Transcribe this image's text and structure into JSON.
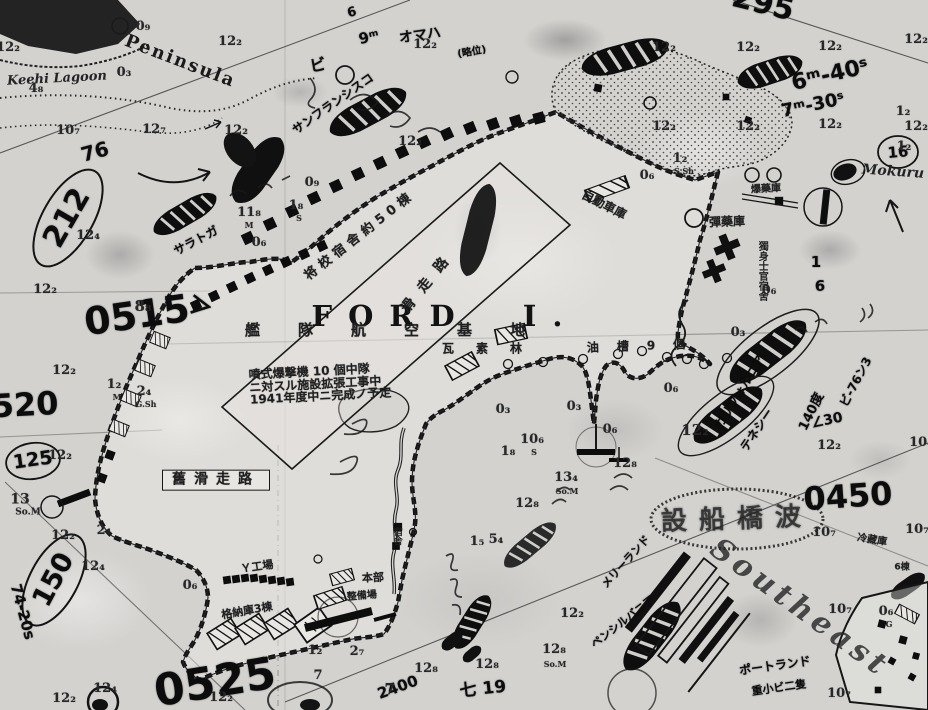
{
  "meta": {
    "chart_subject": "FORD  I."
  },
  "labels": [
    {
      "n": "island-name",
      "t": "FORD  I.",
      "x": 445,
      "y": 316,
      "fs": 29,
      "ls": 16,
      "cls": "print-big"
    },
    {
      "n": "place-name-keehi-lagoon",
      "t": "Keehi Lagoon",
      "x": 57,
      "y": 79,
      "fs": 13,
      "rot": -3,
      "cls": "italic"
    },
    {
      "n": "place-name-peninsula",
      "t": "Peninsula",
      "x": 180,
      "y": 62,
      "fs": 18,
      "rot": 21,
      "ls": 2,
      "cls": "print-serif"
    },
    {
      "n": "place-name-mokuru",
      "t": "Mokuru",
      "x": 893,
      "y": 172,
      "fs": 14,
      "rot": 4,
      "cls": "italic"
    },
    {
      "n": "place-name-southeast",
      "t": "Southeast",
      "x": 800,
      "y": 608,
      "fs": 30,
      "rot": 36,
      "ls": 5,
      "cls": "italic faint"
    },
    {
      "n": "handwritten-time-0515",
      "t": "0515",
      "x": 137,
      "y": 316,
      "fs": 38,
      "rot": -8,
      "cls": "hand"
    },
    {
      "n": "handwritten-number-212",
      "t": "212",
      "x": 67,
      "y": 218,
      "fs": 30,
      "rot": -60,
      "cls": "hand"
    },
    {
      "n": "handwritten-number-76",
      "t": "76",
      "x": 95,
      "y": 152,
      "fs": 20,
      "rot": -15,
      "cls": "hand"
    },
    {
      "n": "handwritten-time-0520",
      "t": "0520",
      "x": 14,
      "y": 406,
      "fs": 32,
      "rot": -3,
      "cls": "hand"
    },
    {
      "n": "handwritten-number-125",
      "t": "125",
      "x": 33,
      "y": 461,
      "fs": 19,
      "rot": -8,
      "cls": "hand"
    },
    {
      "n": "handwritten-number-150",
      "t": "150",
      "x": 54,
      "y": 580,
      "fs": 27,
      "rot": -62,
      "cls": "hand"
    },
    {
      "n": "handwritten-note-74-20s",
      "t": "74-20s",
      "x": 22,
      "y": 612,
      "fs": 15,
      "rot": 75,
      "cls": "hand"
    },
    {
      "n": "handwritten-time-0525",
      "t": "0525",
      "x": 215,
      "y": 683,
      "fs": 44,
      "rot": -9,
      "cls": "hand"
    },
    {
      "n": "handwritten-time-0450",
      "t": "0450",
      "x": 848,
      "y": 497,
      "fs": 32,
      "rot": -4,
      "cls": "hand"
    },
    {
      "n": "handwritten-number-295",
      "t": "295",
      "x": 763,
      "y": 4,
      "fs": 30,
      "rot": 14,
      "cls": "hand"
    },
    {
      "n": "handwritten-time-6m40s",
      "t": "6ᵐ-40ˢ",
      "x": 830,
      "y": 75,
      "fs": 22,
      "rot": -13,
      "cls": "hand"
    },
    {
      "n": "handwritten-time-7m30s",
      "t": "7ᵐ-30ˢ",
      "x": 813,
      "y": 106,
      "fs": 18,
      "rot": -12,
      "cls": "hand"
    },
    {
      "n": "handwritten-note-140deg",
      "t": "140度",
      "x": 812,
      "y": 412,
      "fs": 13,
      "rot": -64,
      "cls": "hand"
    },
    {
      "n": "handwritten-note-bi76",
      "t": "ビ-76ン3",
      "x": 856,
      "y": 382,
      "fs": 12,
      "rot": -62,
      "cls": "hand"
    },
    {
      "n": "handwritten-note-30",
      "t": "∠30",
      "x": 827,
      "y": 421,
      "fs": 14,
      "rot": -12,
      "cls": "hand"
    },
    {
      "n": "handwritten-number-16",
      "t": "16",
      "x": 898,
      "y": 153,
      "fs": 15,
      "rot": -5,
      "cls": "hand"
    },
    {
      "n": "handwritten-number-1",
      "t": "1",
      "x": 816,
      "y": 263,
      "fs": 15,
      "cls": "hand"
    },
    {
      "n": "handwritten-number-6",
      "t": "6",
      "x": 820,
      "y": 287,
      "fs": 15,
      "cls": "hand"
    },
    {
      "n": "handwritten-note-hi19",
      "t": "七 19",
      "x": 483,
      "y": 690,
      "fs": 17,
      "rot": -6,
      "cls": "hand"
    },
    {
      "n": "handwritten-number-2400",
      "t": "2400",
      "x": 398,
      "y": 688,
      "fs": 15,
      "rot": -20,
      "cls": "hand"
    },
    {
      "n": "handwritten-ship-omaha",
      "t": "オマハ",
      "x": 420,
      "y": 36,
      "fs": 14,
      "rot": -8,
      "cls": "hand"
    },
    {
      "n": "handwritten-time-9m",
      "t": "9ᵐ",
      "x": 369,
      "y": 38,
      "fs": 15,
      "rot": -12,
      "cls": "hand"
    },
    {
      "n": "handwritten-number-6b",
      "t": "6",
      "x": 352,
      "y": 13,
      "fs": 13,
      "rot": -15,
      "cls": "hand"
    },
    {
      "n": "handwritten-note-bi",
      "t": "ビ",
      "x": 318,
      "y": 66,
      "fs": 16,
      "rot": -10,
      "cls": "hand"
    },
    {
      "n": "handwritten-note-ryakui",
      "t": "(略位)",
      "x": 472,
      "y": 53,
      "fs": 10,
      "rot": -10,
      "cls": "hand"
    },
    {
      "n": "handwritten-ship-san-francisco",
      "t": "サンフランシスコ",
      "x": 333,
      "y": 104,
      "fs": 12,
      "rot": -35,
      "cls": "hand"
    },
    {
      "n": "handwritten-ship-saratoga",
      "t": "サラトガ",
      "x": 196,
      "y": 241,
      "fs": 12,
      "rot": -28,
      "cls": "hand"
    },
    {
      "n": "handwritten-ship-california",
      "t": "カリフォルニア",
      "x": 740,
      "y": 392,
      "fs": 12,
      "rot": -58,
      "cls": "hand"
    },
    {
      "n": "handwritten-ship-tennessee",
      "t": "テネシー",
      "x": 757,
      "y": 430,
      "fs": 12,
      "rot": -56,
      "cls": "hand"
    },
    {
      "n": "handwritten-ship-maryland",
      "t": "メリーランド",
      "x": 626,
      "y": 562,
      "fs": 11,
      "rot": -48,
      "cls": "hand"
    },
    {
      "n": "handwritten-ship-pennsylvania",
      "t": "ペンシルバニア",
      "x": 623,
      "y": 622,
      "fs": 11,
      "rot": -38,
      "cls": "hand"
    },
    {
      "n": "handwritten-ship-portland",
      "t": "ポートランド",
      "x": 775,
      "y": 666,
      "fs": 12,
      "rot": -8,
      "cls": "hand"
    },
    {
      "n": "handwritten-note-ships",
      "t": "重小ビ二隻",
      "x": 779,
      "y": 688,
      "fs": 11,
      "rot": -8,
      "cls": "hand"
    },
    {
      "n": "handwritten-arrow-mark",
      "t": "＞",
      "x": 201,
      "y": 307,
      "fs": 24,
      "rot": 10,
      "cls": "hand"
    },
    {
      "n": "jp-label-auto-garage",
      "t": "自動車庫",
      "x": 604,
      "y": 205,
      "fs": 12,
      "rot": 27,
      "cls": "jp"
    },
    {
      "n": "jp-label-bomb-magazine",
      "t": "爆藥庫",
      "x": 766,
      "y": 190,
      "fs": 10,
      "rot": -3,
      "cls": "jp"
    },
    {
      "n": "jp-label-ammo-depot",
      "t": "彈藥庫",
      "x": 727,
      "y": 222,
      "fs": 12,
      "rot": -2,
      "cls": "jp"
    },
    {
      "n": "jp-label-boq",
      "t": "獨身士官宿舍",
      "x": 761,
      "y": 271,
      "fs": 10,
      "cls": "jp-vert"
    },
    {
      "n": "jp-label-officers-quarters",
      "t": "将校宿舎約50棟",
      "x": 360,
      "y": 236,
      "fs": 13,
      "rot": -38,
      "ls": 5,
      "cls": "jp"
    },
    {
      "n": "jp-label-runway",
      "t": "滑走路",
      "x": 429,
      "y": 281,
      "fs": 14,
      "rot": -51,
      "ls": 12,
      "cls": "jp"
    },
    {
      "n": "jp-label-fleet-air-base",
      "t": "艦隊航空基地",
      "x": 404,
      "y": 331,
      "fs": 15,
      "ls": 38,
      "cls": "jp"
    },
    {
      "n": "jp-label-gasoline",
      "t": "瓦素林",
      "x": 493,
      "y": 349,
      "fs": 12,
      "ls": 22,
      "cls": "jp"
    },
    {
      "n": "jp-label-oil-tanks",
      "t": "油槽9個",
      "x": 645,
      "y": 346,
      "fs": 12,
      "ls": 18,
      "rot": -2,
      "cls": "jp"
    },
    {
      "n": "jp-label-old-runway",
      "t": "舊滑走路",
      "x": 216,
      "y": 480,
      "fs": 14,
      "ls": 8,
      "cls": "jp boxed"
    },
    {
      "n": "jp-annotation-expansion",
      "t": "噴式爆撃機 10 個中隊\nニ対スル施設拡張工事中\n1941年度中ニ完成ノ予定",
      "x": 320,
      "y": 384,
      "fs": 12,
      "rot": -3,
      "cls": "jp"
    },
    {
      "n": "jp-label-hangars-3",
      "t": "格納庫3棟",
      "x": 247,
      "y": 611,
      "fs": 11,
      "rot": -10,
      "cls": "jp"
    },
    {
      "n": "jp-label-factory",
      "t": "Ｙ工場",
      "x": 257,
      "y": 567,
      "fs": 11,
      "rot": -8,
      "cls": "jp"
    },
    {
      "n": "jp-label-headquarters",
      "t": "本部",
      "x": 373,
      "y": 578,
      "fs": 11,
      "rot": -3,
      "cls": "jp"
    },
    {
      "n": "jp-label-maintenance",
      "t": "整備場",
      "x": 362,
      "y": 597,
      "fs": 10,
      "rot": -5,
      "cls": "jp"
    },
    {
      "n": "jp-label-quarters",
      "t": "宿舎",
      "x": 396,
      "y": 536,
      "fs": 9,
      "cls": "jp-vert"
    },
    {
      "n": "jp-label-cold-storage",
      "t": "冷藏庫",
      "x": 872,
      "y": 541,
      "fs": 10,
      "rot": 9,
      "cls": "jp"
    },
    {
      "n": "jp-label-6-buildings",
      "t": "6棟",
      "x": 902,
      "y": 568,
      "fs": 9,
      "cls": "jp"
    },
    {
      "n": "jp-stamp-oval",
      "t": "設船橋波",
      "x": 737,
      "y": 520,
      "fs": 26,
      "ls": 12,
      "rot": -2,
      "cls": "stamp"
    },
    {
      "n": "depth-sounding",
      "t": "0₉",
      "x": 143,
      "y": 27
    },
    {
      "n": "depth-sounding",
      "t": "12₂",
      "x": 230,
      "y": 42
    },
    {
      "n": "depth-sounding",
      "t": "12₂",
      "x": 8,
      "y": 48
    },
    {
      "n": "depth-sounding",
      "t": "0₃",
      "x": 124,
      "y": 73
    },
    {
      "n": "depth-sounding",
      "t": "4₈",
      "x": 36,
      "y": 89
    },
    {
      "n": "depth-sounding",
      "t": "10₇",
      "x": 68,
      "y": 131
    },
    {
      "n": "depth-sounding",
      "t": "12₇",
      "x": 154,
      "y": 130
    },
    {
      "n": "depth-sounding",
      "t": "12₂",
      "x": 236,
      "y": 131
    },
    {
      "n": "depth-sounding",
      "t": "0₉",
      "x": 312,
      "y": 183
    },
    {
      "n": "depth-sounding",
      "t": "1₈",
      "x": 296,
      "y": 206
    },
    {
      "n": "bottom-type",
      "t": "S",
      "x": 299,
      "y": 218,
      "fs": 8
    },
    {
      "n": "depth-sounding",
      "t": "11₈",
      "x": 249,
      "y": 213
    },
    {
      "n": "bottom-type",
      "t": "M",
      "x": 249,
      "y": 225,
      "fs": 8
    },
    {
      "n": "depth-sounding",
      "t": "12₄",
      "x": 88,
      "y": 236
    },
    {
      "n": "depth-sounding",
      "t": "12₂",
      "x": 45,
      "y": 290
    },
    {
      "n": "depth-sounding",
      "t": "8₈",
      "x": 143,
      "y": 307,
      "fs": 15
    },
    {
      "n": "depth-sounding",
      "t": "12₂",
      "x": 64,
      "y": 371
    },
    {
      "n": "depth-sounding",
      "t": "1₂",
      "x": 114,
      "y": 385
    },
    {
      "n": "bottom-type",
      "t": "M",
      "x": 117,
      "y": 397,
      "fs": 8
    },
    {
      "n": "depth-sounding",
      "t": "2₄",
      "x": 144,
      "y": 392
    },
    {
      "n": "bottom-type",
      "t": "G.Sh",
      "x": 146,
      "y": 404,
      "fs": 8
    },
    {
      "n": "depth-sounding",
      "t": "0₆",
      "x": 259,
      "y": 243
    },
    {
      "n": "depth-sounding",
      "t": "12₂",
      "x": 425,
      "y": 45
    },
    {
      "n": "depth-sounding",
      "t": "12₂",
      "x": 410,
      "y": 142
    },
    {
      "n": "depth-sounding",
      "t": "12₂",
      "x": 664,
      "y": 48
    },
    {
      "n": "depth-sounding",
      "t": "12₂",
      "x": 748,
      "y": 48
    },
    {
      "n": "depth-sounding",
      "t": "12₂",
      "x": 830,
      "y": 47
    },
    {
      "n": "depth-sounding",
      "t": "12₂",
      "x": 916,
      "y": 40
    },
    {
      "n": "depth-sounding",
      "t": "12₂",
      "x": 664,
      "y": 127
    },
    {
      "n": "depth-sounding",
      "t": "12₂",
      "x": 748,
      "y": 127
    },
    {
      "n": "depth-sounding",
      "t": "12₂",
      "x": 830,
      "y": 125
    },
    {
      "n": "depth-sounding",
      "t": "12₂",
      "x": 916,
      "y": 127
    },
    {
      "n": "depth-sounding",
      "t": "1₂",
      "x": 903,
      "y": 112
    },
    {
      "n": "depth-sounding",
      "t": "1₂",
      "x": 904,
      "y": 147
    },
    {
      "n": "depth-sounding",
      "t": "1₂",
      "x": 680,
      "y": 159
    },
    {
      "n": "bottom-type",
      "t": "S.Sh",
      "x": 684,
      "y": 171,
      "fs": 8
    },
    {
      "n": "depth-sounding",
      "t": "0₆",
      "x": 647,
      "y": 176
    },
    {
      "n": "depth-sounding",
      "t": "0₆",
      "x": 769,
      "y": 291
    },
    {
      "n": "depth-sounding",
      "t": "0₃",
      "x": 738,
      "y": 333
    },
    {
      "n": "depth-sounding",
      "t": "0₆",
      "x": 671,
      "y": 389
    },
    {
      "n": "depth-sounding",
      "t": "0₃",
      "x": 503,
      "y": 410
    },
    {
      "n": "depth-sounding",
      "t": "0₃",
      "x": 574,
      "y": 407
    },
    {
      "n": "depth-sounding",
      "t": "0₆",
      "x": 610,
      "y": 430
    },
    {
      "n": "depth-sounding",
      "t": "10₆",
      "x": 532,
      "y": 440
    },
    {
      "n": "bottom-type",
      "t": "S",
      "x": 534,
      "y": 452,
      "fs": 8
    },
    {
      "n": "depth-sounding",
      "t": "1₈",
      "x": 508,
      "y": 452
    },
    {
      "n": "depth-sounding",
      "t": "13₄",
      "x": 566,
      "y": 478
    },
    {
      "n": "bottom-type",
      "t": "So.M",
      "x": 567,
      "y": 491,
      "fs": 8
    },
    {
      "n": "depth-sounding",
      "t": "12₈",
      "x": 625,
      "y": 464
    },
    {
      "n": "depth-sounding",
      "t": "12₂",
      "x": 695,
      "y": 431,
      "fs": 15
    },
    {
      "n": "depth-sounding",
      "t": "12₂",
      "x": 829,
      "y": 446
    },
    {
      "n": "depth-sounding",
      "t": "10₄",
      "x": 921,
      "y": 443
    },
    {
      "n": "depth-sounding",
      "t": "12₈",
      "x": 527,
      "y": 504
    },
    {
      "n": "depth-sounding",
      "t": "5₄",
      "x": 496,
      "y": 540
    },
    {
      "n": "depth-sounding",
      "t": "1₅",
      "x": 477,
      "y": 542
    },
    {
      "n": "depth-sounding",
      "t": "12₂",
      "x": 572,
      "y": 614
    },
    {
      "n": "depth-sounding",
      "t": "12₈",
      "x": 554,
      "y": 650
    },
    {
      "n": "bottom-type",
      "t": "So.M",
      "x": 555,
      "y": 664,
      "fs": 8
    },
    {
      "n": "depth-sounding",
      "t": "12₈",
      "x": 487,
      "y": 665
    },
    {
      "n": "depth-sounding",
      "t": "12₈",
      "x": 426,
      "y": 669
    },
    {
      "n": "depth-sounding",
      "t": "1₂",
      "x": 315,
      "y": 651
    },
    {
      "n": "depth-sounding",
      "t": "2₇",
      "x": 357,
      "y": 652
    },
    {
      "n": "depth-sounding",
      "t": "7",
      "x": 318,
      "y": 676
    },
    {
      "n": "depth-sounding",
      "t": "7",
      "x": 390,
      "y": 690,
      "fs": 16
    },
    {
      "n": "depth-sounding",
      "t": "12₂",
      "x": 64,
      "y": 699
    },
    {
      "n": "depth-sounding",
      "t": "12₂",
      "x": 221,
      "y": 698
    },
    {
      "n": "depth-sounding",
      "t": "12₄",
      "x": 105,
      "y": 689
    },
    {
      "n": "depth-sounding",
      "t": "13",
      "x": 20,
      "y": 500,
      "fs": 14
    },
    {
      "n": "bottom-type",
      "t": "So.M",
      "x": 28,
      "y": 513,
      "fs": 9
    },
    {
      "n": "depth-sounding",
      "t": "2₄",
      "x": 104,
      "y": 531
    },
    {
      "n": "depth-sounding",
      "t": "12₂",
      "x": 63,
      "y": 536
    },
    {
      "n": "depth-sounding",
      "t": "12₄",
      "x": 93,
      "y": 567
    },
    {
      "n": "depth-sounding",
      "t": "12₂",
      "x": 60,
      "y": 456
    },
    {
      "n": "depth-sounding",
      "t": "0₆",
      "x": 190,
      "y": 586
    },
    {
      "n": "depth-sounding",
      "t": "10₇",
      "x": 824,
      "y": 533
    },
    {
      "n": "depth-sounding",
      "t": "10₇",
      "x": 840,
      "y": 610
    },
    {
      "n": "depth-sounding",
      "t": "10₇",
      "x": 839,
      "y": 694
    },
    {
      "n": "depth-sounding",
      "t": "10₇",
      "x": 917,
      "y": 530
    },
    {
      "n": "depth-sounding",
      "t": "0₆",
      "x": 886,
      "y": 612
    },
    {
      "n": "bottom-type",
      "t": "G",
      "x": 889,
      "y": 624,
      "fs": 8
    }
  ]
}
